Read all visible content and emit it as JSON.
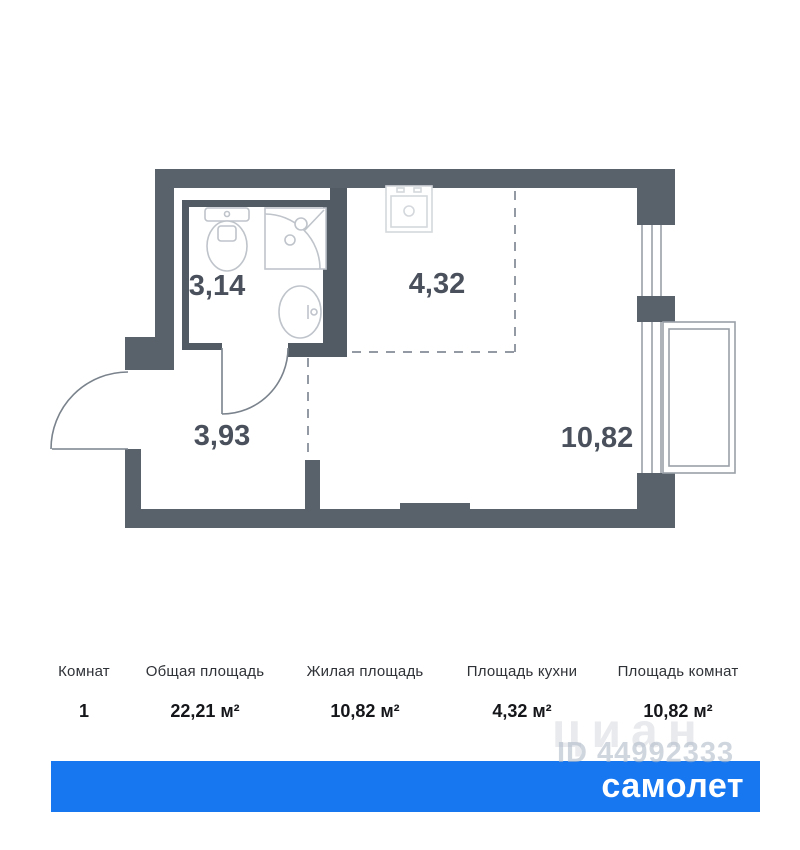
{
  "plan": {
    "rooms": [
      {
        "name": "bathroom",
        "area": "3,14"
      },
      {
        "name": "kitchen",
        "area": "4,32"
      },
      {
        "name": "hallway",
        "area": "3,93"
      },
      {
        "name": "living-room",
        "area": "10,82"
      }
    ]
  },
  "summary": {
    "columns": [
      {
        "header": "Комнат",
        "value": "1"
      },
      {
        "header": "Общая площадь",
        "value": "22,21 м²"
      },
      {
        "header": "Жилая площадь",
        "value": "10,82 м²"
      },
      {
        "header": "Площадь кухни",
        "value": "4,32 м²"
      },
      {
        "header": "Площадь комнат",
        "value": "10,82 м²"
      }
    ]
  },
  "watermark": {
    "brand": "циан",
    "listing_id": "ID 44992333"
  },
  "footer": {
    "logo_text": "самолет"
  },
  "colors": {
    "wall": "#59616B",
    "wall_inner": "#525A64",
    "accent_blue": "#1677F0",
    "room_label": "#4A515C"
  }
}
